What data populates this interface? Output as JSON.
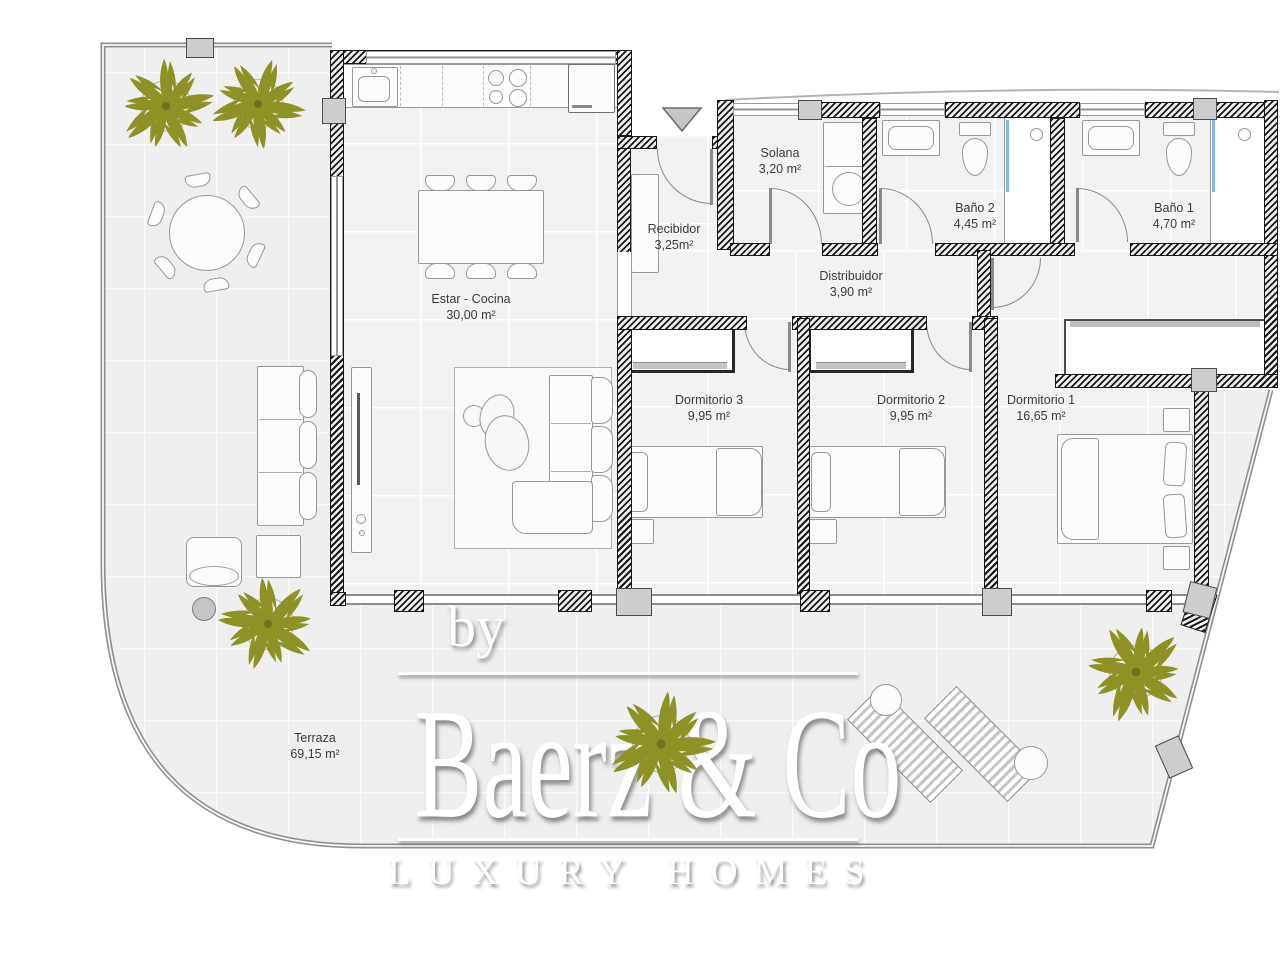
{
  "plan": {
    "rooms": [
      {
        "id": "estar-cocina",
        "label": "Estar - Cocina",
        "area": "30,00 m²"
      },
      {
        "id": "recibidor",
        "label": "Recibidor",
        "area": "3,25m²"
      },
      {
        "id": "solana",
        "label": "Solana",
        "area": "3,20 m²"
      },
      {
        "id": "bano-2",
        "label": "Baño 2",
        "area": "4,45 m²"
      },
      {
        "id": "bano-1",
        "label": "Baño 1",
        "area": "4,70 m²"
      },
      {
        "id": "distribuidor",
        "label": "Distribuidor",
        "area": "3,90 m²"
      },
      {
        "id": "dormitorio-3",
        "label": "Dormitorio 3",
        "area": "9,95 m²"
      },
      {
        "id": "dormitorio-2",
        "label": "Dormitorio 2",
        "area": "9,95 m²"
      },
      {
        "id": "dormitorio-1",
        "label": "Dormitorio 1",
        "area": "16,65 m²"
      },
      {
        "id": "terraza",
        "label": "Terraza",
        "area": "69,15 m²"
      }
    ]
  },
  "watermark": {
    "prefix": "by",
    "brand": "Baerz & Co",
    "tagline": "LUXURY HOMES"
  },
  "colors": {
    "palm": "#8e9126",
    "wall": "#171717",
    "terrace_floor": "#efefef",
    "interior_floor": "#f2f2f2",
    "shower_accent": "#86b7dd",
    "watermark": "#ffffff"
  }
}
